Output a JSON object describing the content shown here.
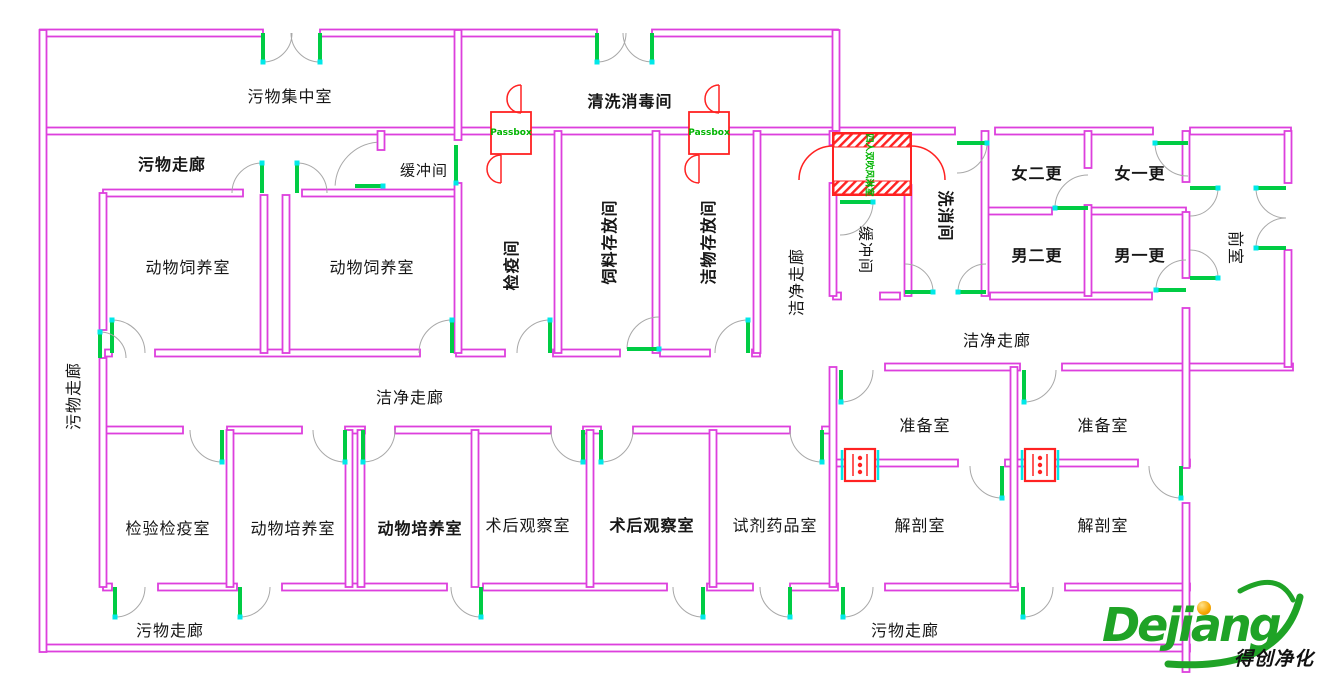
{
  "labels": {
    "waste_collection_room": "污物集中室",
    "cleaning_disinfection_room": "清洗消毒间",
    "waste_corridor": "污物走廊",
    "buffer_room": "缓冲间",
    "animal_breeding_room": "动物饲养室",
    "quarantine_room": "检疫间",
    "feed_storage_room": "饲料存放间",
    "clean_storage_room": "洁物存放间",
    "clean_corridor": "洁净走廊",
    "washing_room": "洗消间",
    "female_second_change": "女二更",
    "female_first_change": "女一更",
    "male_second_change": "男二更",
    "male_first_change": "男一更",
    "anteroom": "前室",
    "prep_room": "准备室",
    "dissection_room": "解剖室",
    "inspection_quarantine_room": "检验检疫室",
    "animal_culture_room": "动物培养室",
    "post_op_observation_room": "术后观察室",
    "reagent_room": "试剂药品室",
    "passbox": "Passbox",
    "air_shower": "四人双吹风淋室"
  },
  "logo": {
    "brand": "Dejiang",
    "tagline": "得创净化"
  },
  "colors": {
    "wall": "#DD3FDD",
    "door_arc": "#A8A8A8",
    "door_leaf": "#00CC44",
    "leaf_tip": "#00E8E8",
    "symbol_red": "#FF2222",
    "passbox_text": "#00B400",
    "logo_green": "#1FA326",
    "logo_dot": "#F7A600"
  }
}
